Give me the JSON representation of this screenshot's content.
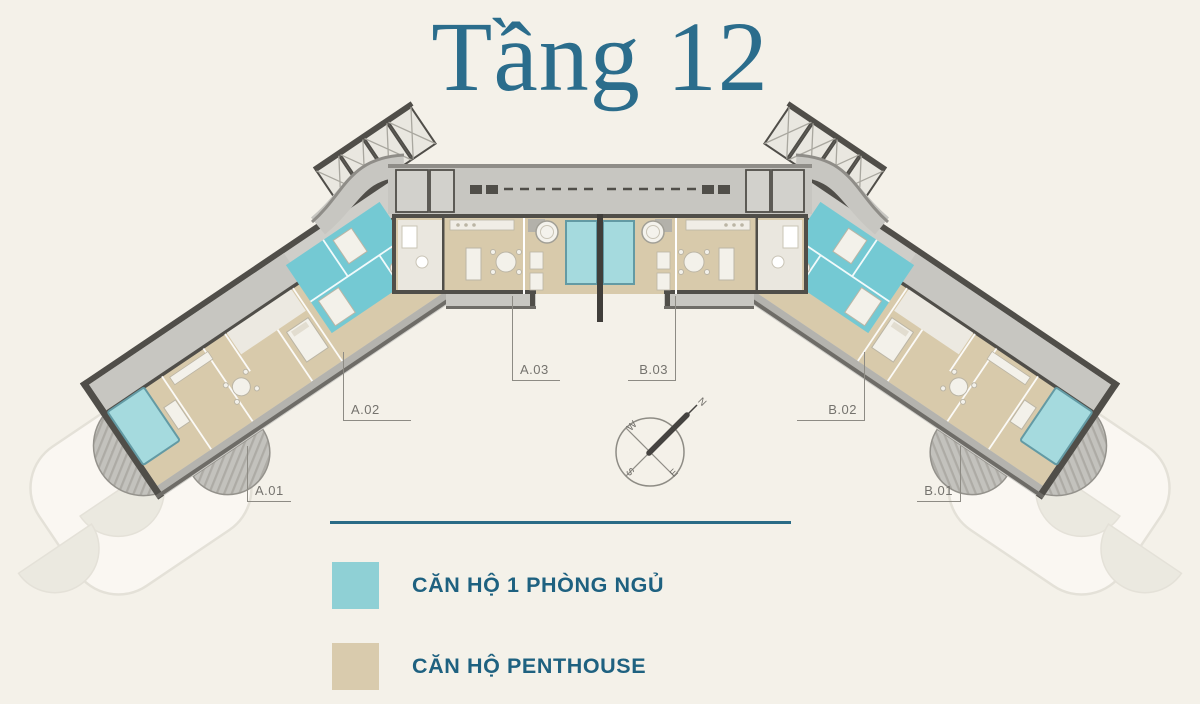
{
  "title": "Tầng 12",
  "plan": {
    "units": {
      "a01": "A.01",
      "a02": "A.02",
      "a03": "A.03",
      "b03": "B.03",
      "b02": "B.02",
      "b01": "B.01"
    },
    "compass": {
      "north": "N",
      "south": "S",
      "east": "E",
      "west": "W"
    }
  },
  "legend": {
    "items": [
      {
        "label": "CĂN HỘ 1 PHÒNG NGỦ",
        "color": "#8FD0D5"
      },
      {
        "label": "CĂN HỘ PENTHOUSE",
        "color": "#D9CBAD"
      }
    ]
  },
  "colors": {
    "background": "#F4F1E9",
    "title_text": "#2B6D8C",
    "legend_text": "#1E6180",
    "divider": "#2A6B86",
    "one_bedroom_fill": "#74C9D3",
    "penthouse_fill": "#D8CAAB",
    "pool_fill": "#A5DADE",
    "corridor_gray": "#C7C6C1",
    "wall_dark": "#504E49"
  }
}
